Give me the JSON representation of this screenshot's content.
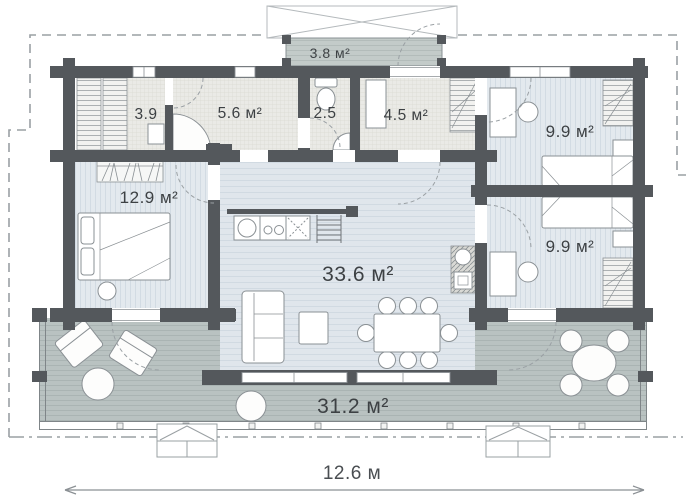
{
  "rooms": {
    "porch": "3.8 м²",
    "storage": "3.9",
    "hallway": "5.6 м²",
    "wc": "2.5",
    "vestibule": "4.5 м²",
    "bedroom_top_right": "9.9 м²",
    "bedroom_bottom_right": "9.9 м²",
    "bedroom_left": "12.9 м²",
    "living_kitchen": "33.6 м²",
    "terrace": "31.2 м²"
  },
  "dimension": {
    "total_width": "12.6 м"
  },
  "colors": {
    "wall": "#54585c",
    "wet_floor": "#eaeae6",
    "bedroom_floor": "#e3e9ee",
    "living_floor": "#e0e6ec",
    "terrace_floor": "#b9c2c1",
    "porch_deck": "#c3cbc9",
    "label_text": "#3d4144",
    "roof_dash": "#9aa0a4",
    "furniture_line": "#8a9094"
  }
}
